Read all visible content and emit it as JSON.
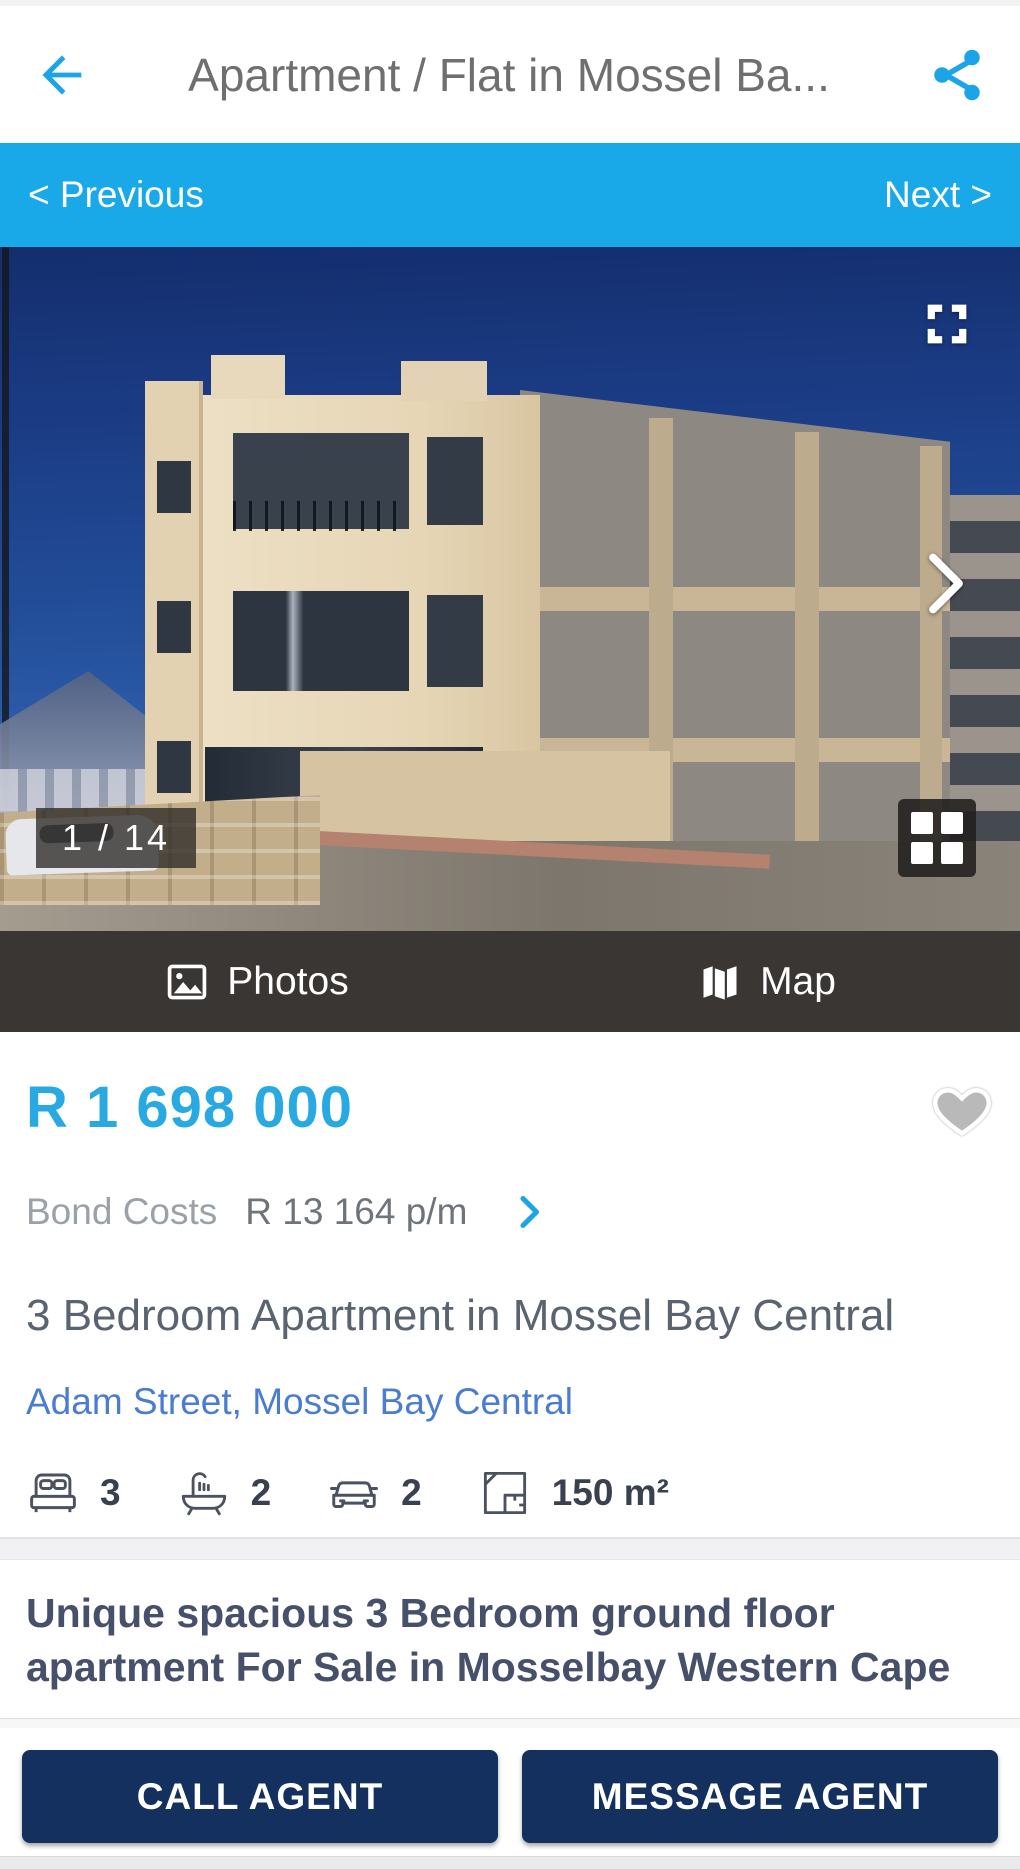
{
  "header": {
    "title": "Apartment / Flat in Mossel Ba..."
  },
  "gallery_nav": {
    "previous_label": "< Previous",
    "next_label": "Next >"
  },
  "photo": {
    "counter": "1 / 14"
  },
  "media_tabs": {
    "photos_label": "Photos",
    "map_label": "Map"
  },
  "listing": {
    "price": "R 1 698 000",
    "bond_costs_label": "Bond Costs",
    "bond_costs_value": "R 13 164 p/m",
    "title": "3 Bedroom Apartment in Mossel Bay Central",
    "address": "Adam Street, Mossel Bay Central",
    "specs": [
      {
        "icon": "bed-icon",
        "value": "3"
      },
      {
        "icon": "bath-icon",
        "value": "2"
      },
      {
        "icon": "car-icon",
        "value": "2"
      },
      {
        "icon": "floor-size-icon",
        "value": "150 m²"
      }
    ]
  },
  "description": {
    "headline": "Unique spacious 3 Bedroom ground floor apartment For Sale in Mosselbay Western Cape"
  },
  "actions": {
    "call_label": "CALL AGENT",
    "message_label": "MESSAGE AGENT"
  },
  "colors": {
    "accent_blue": "#1ba5e8",
    "nav_bar_blue": "#19a9e8",
    "price_blue": "#29a9e1",
    "link_blue": "#4a7cd1",
    "button_navy": "#14305e",
    "media_bar_dark": "#3a3633"
  }
}
